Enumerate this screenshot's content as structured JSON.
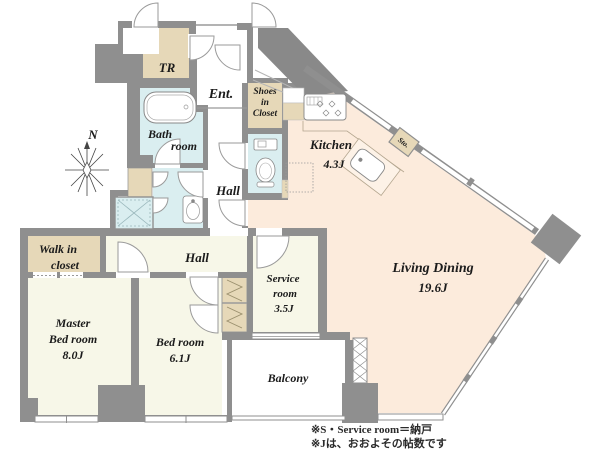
{
  "plan_type": "floor-plan",
  "colors": {
    "wall": "#8f8f8f",
    "wall_dark": "#898989",
    "floor_cream": "#f7f7e8",
    "floor_peach": "#fcebdc",
    "closet_tan": "#e6d8b8",
    "water_blue": "#daeef0",
    "fixture_stroke": "#888888"
  },
  "compass": {
    "north": "N"
  },
  "rooms": {
    "tr": {
      "label": "TR"
    },
    "entrance": {
      "label": "Ent."
    },
    "shoes_closet": {
      "l1": "Shoes",
      "l2": "in",
      "l3": "Closet"
    },
    "bathroom": {
      "l1": "Bath",
      "l2": "room"
    },
    "hall_upper": {
      "label": "Hall"
    },
    "hall_lower": {
      "label": "Hall"
    },
    "kitchen": {
      "label": "Kitchen",
      "area": "4.3J"
    },
    "storage": {
      "label": "Sto."
    },
    "living_dining": {
      "label": "Living Dining",
      "area": "19.6J"
    },
    "service_room": {
      "l1": "Service",
      "l2": "room",
      "area": "3.5J"
    },
    "walk_in_closet": {
      "l1": "Walk in",
      "l2": "closet"
    },
    "master_bedroom": {
      "l1": "Master",
      "l2": "Bed room",
      "area": "8.0J"
    },
    "bedroom": {
      "label": "Bed room",
      "area": "6.1J"
    },
    "balcony": {
      "label": "Balcony"
    }
  },
  "notes": {
    "line1": "※S・Service room＝納戸",
    "line2": "※Jは、おおよその帖数です"
  }
}
